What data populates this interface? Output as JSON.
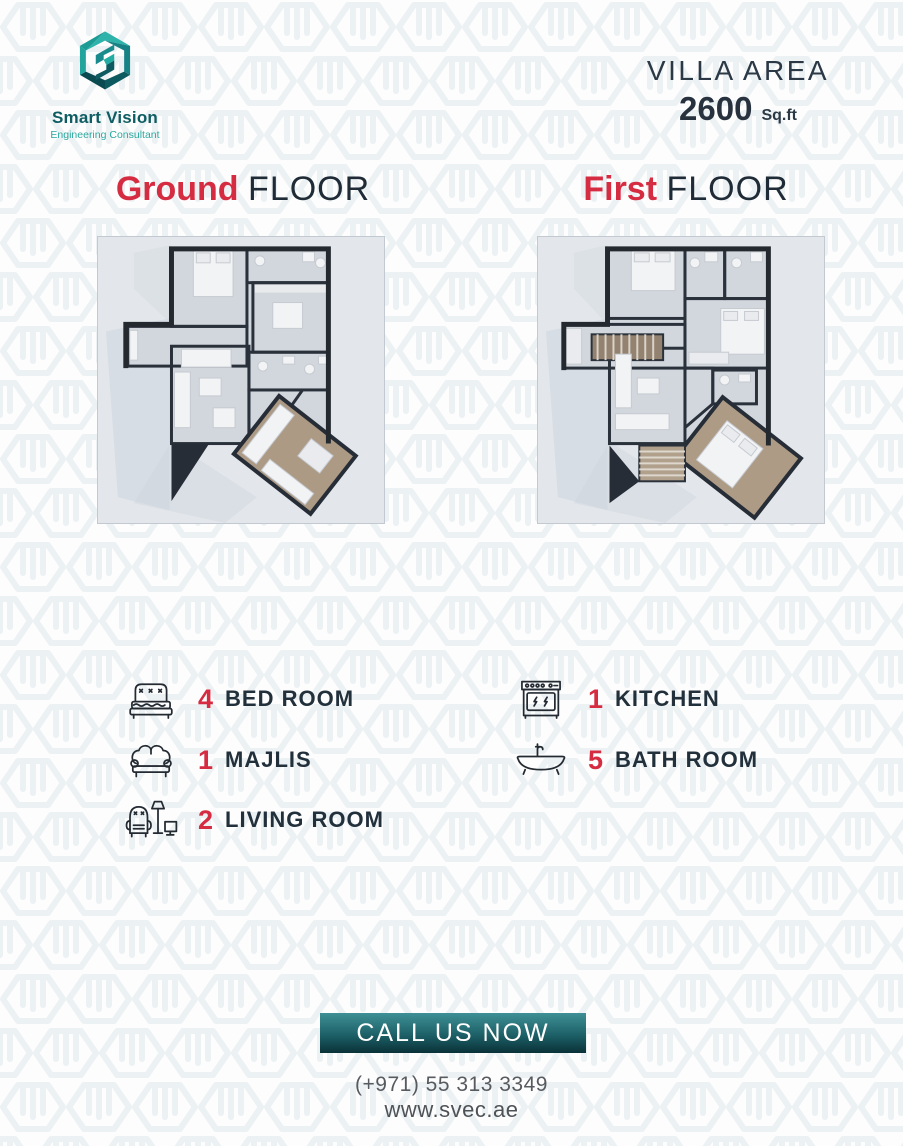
{
  "brand": {
    "name": "Smart Vision",
    "tagline": "Engineering Consultant",
    "logo_icon": "hexagon-s-logo"
  },
  "villa_area": {
    "label": "VILLA AREA",
    "value": "2600",
    "unit": "Sq.ft"
  },
  "floors": [
    {
      "name_accent": "Ground",
      "name_rest": "FLOOR",
      "plan": "ground-floor-plan"
    },
    {
      "name_accent": "First",
      "name_rest": "FLOOR",
      "plan": "first-floor-plan"
    }
  ],
  "features": {
    "left": [
      {
        "icon": "bed-icon",
        "count": "4",
        "label": "BED ROOM"
      },
      {
        "icon": "sofa-icon",
        "count": "1",
        "label": "MAJLIS"
      },
      {
        "icon": "armchair-lamp-icon",
        "count": "2",
        "label": "LIVING ROOM"
      }
    ],
    "right": [
      {
        "icon": "stove-icon",
        "count": "1",
        "label": "KITCHEN"
      },
      {
        "icon": "bathtub-icon",
        "count": "5",
        "label": "BATH ROOM"
      }
    ]
  },
  "cta": {
    "button_label": "CALL US NOW",
    "phone": "(+971) 55 313 3349",
    "website": "www.svec.ae"
  },
  "colors": {
    "accent_red": "#d52c42",
    "navy": "#22303c",
    "teal_dark": "#0e5d62",
    "teal_light": "#2ba89f",
    "button_gradient_top": "#3e9096",
    "button_gradient_bottom": "#0a3138"
  }
}
